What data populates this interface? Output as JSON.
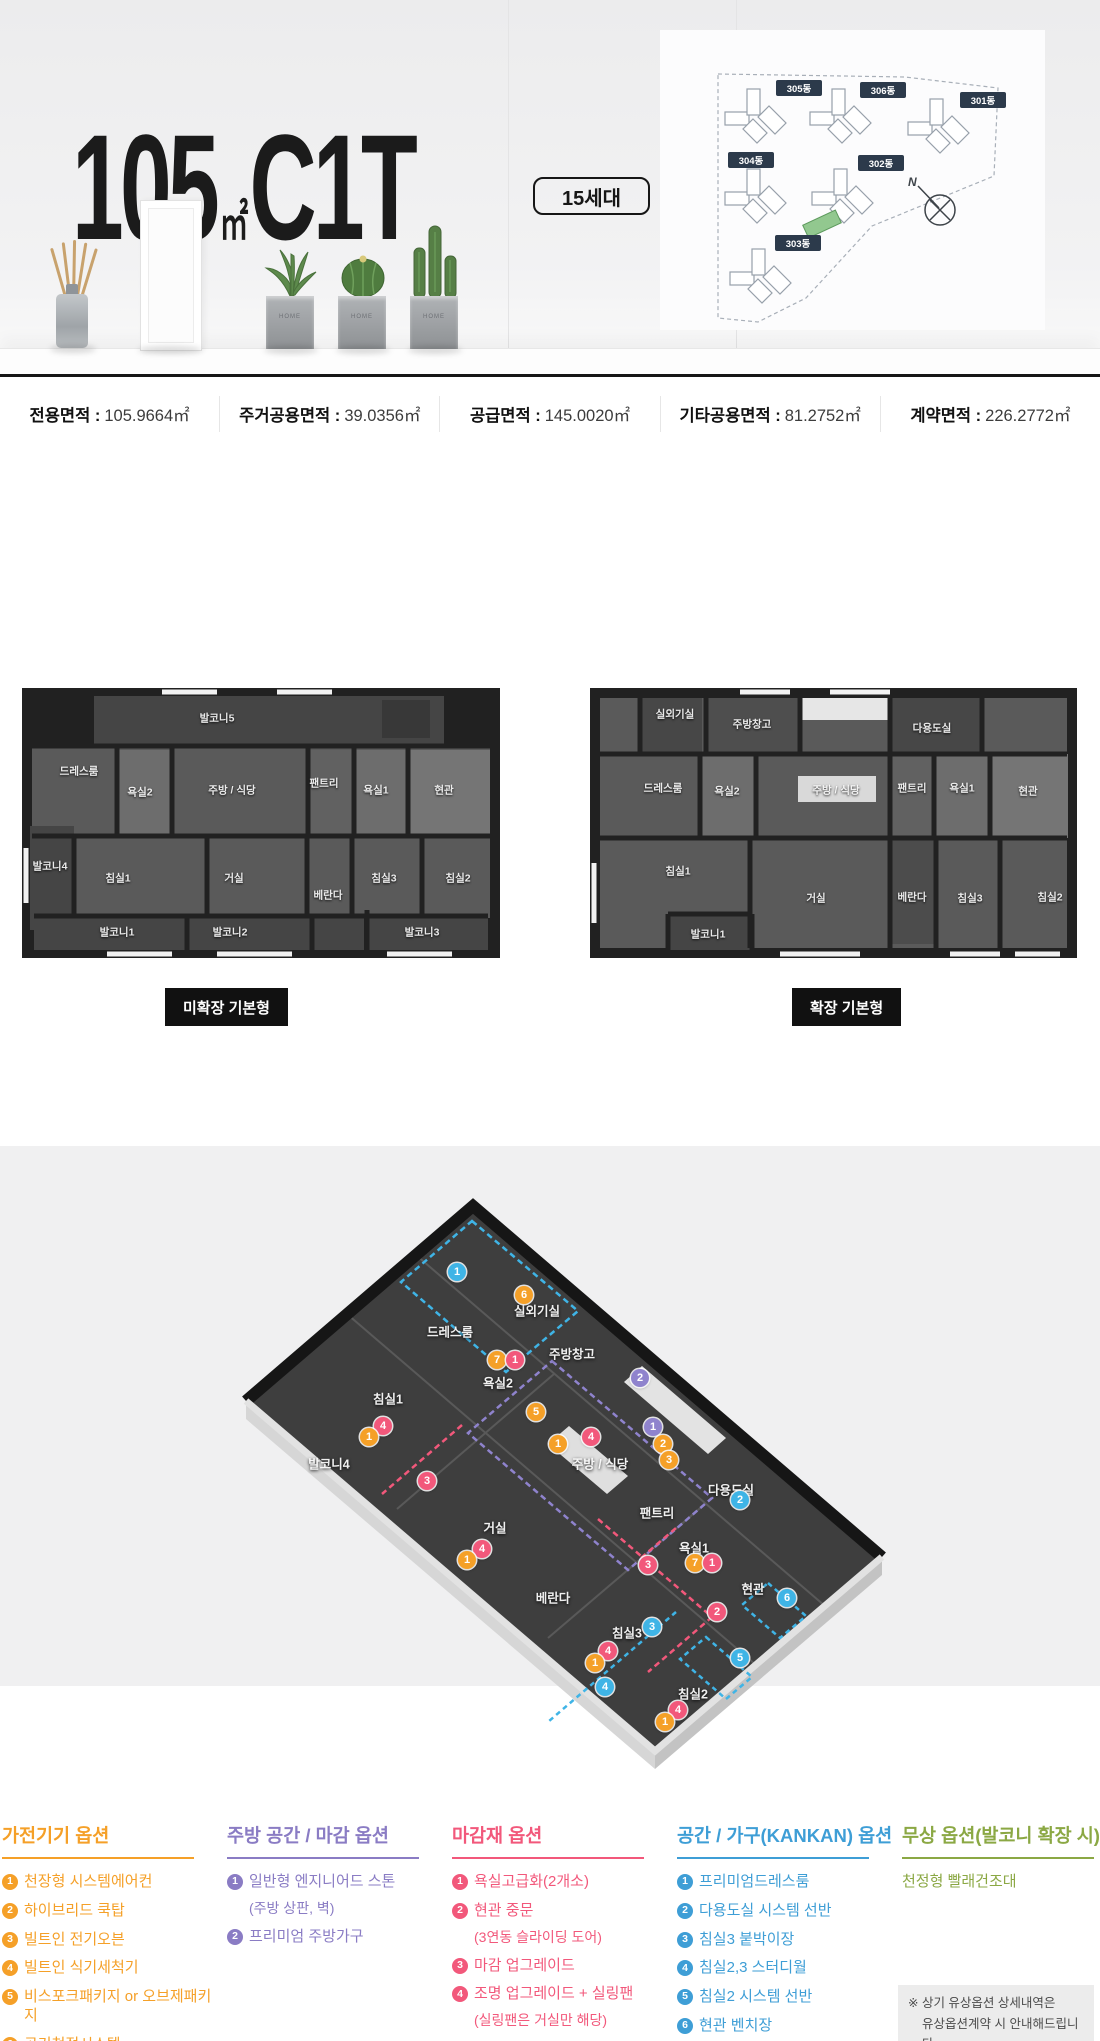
{
  "header": {
    "title": {
      "num": "105",
      "unit": "㎡",
      "type": "C1T"
    },
    "badge": "15세대",
    "site_plan": {
      "buildings": [
        {
          "name": "305동"
        },
        {
          "name": "306동"
        },
        {
          "name": "301동"
        },
        {
          "name": "304동"
        },
        {
          "name": "302동"
        },
        {
          "name": "303동"
        }
      ],
      "compass": "N",
      "highlight_color": "#92C88F",
      "chip_color": "#2C3A4B"
    }
  },
  "area_info": {
    "items": [
      {
        "label": "전용면적",
        "value": "105.9664㎡"
      },
      {
        "label": "주거공용면적",
        "value": "39.0356㎡"
      },
      {
        "label": "공급면적",
        "value": "145.0020㎡"
      },
      {
        "label": "기타공용면적",
        "value": "81.2752㎡"
      },
      {
        "label": "계약면적",
        "value": "226.2772㎡"
      }
    ]
  },
  "floor_plans": {
    "left": {
      "button_label": "미확장 기본형",
      "rooms": [
        {
          "name": "발코니5",
          "x": 195,
          "y": 30
        },
        {
          "name": "드레스룸",
          "x": 57,
          "y": 83
        },
        {
          "name": "욕실2",
          "x": 118,
          "y": 104
        },
        {
          "name": "주방 / 식당",
          "x": 210,
          "y": 102
        },
        {
          "name": "팬트리",
          "x": 302,
          "y": 95
        },
        {
          "name": "욕실1",
          "x": 354,
          "y": 102
        },
        {
          "name": "현관",
          "x": 422,
          "y": 102
        },
        {
          "name": "발코니4",
          "x": 28,
          "y": 178
        },
        {
          "name": "침실1",
          "x": 96,
          "y": 190
        },
        {
          "name": "거실",
          "x": 212,
          "y": 190
        },
        {
          "name": "베란다",
          "x": 306,
          "y": 207
        },
        {
          "name": "침실3",
          "x": 362,
          "y": 190
        },
        {
          "name": "침실2",
          "x": 436,
          "y": 190
        },
        {
          "name": "발코니1",
          "x": 95,
          "y": 244
        },
        {
          "name": "발코니2",
          "x": 208,
          "y": 244
        },
        {
          "name": "발코니3",
          "x": 400,
          "y": 244
        }
      ]
    },
    "right": {
      "button_label": "확장 기본형",
      "rooms": [
        {
          "name": "실외기실",
          "x": 85,
          "y": 26
        },
        {
          "name": "주방창고",
          "x": 162,
          "y": 36
        },
        {
          "name": "다용도실",
          "x": 342,
          "y": 40
        },
        {
          "name": "드레스룸",
          "x": 73,
          "y": 100
        },
        {
          "name": "욕실2",
          "x": 137,
          "y": 103
        },
        {
          "name": "주방 / 식당",
          "x": 246,
          "y": 102
        },
        {
          "name": "팬트리",
          "x": 322,
          "y": 100
        },
        {
          "name": "욕실1",
          "x": 372,
          "y": 100
        },
        {
          "name": "현관",
          "x": 438,
          "y": 103
        },
        {
          "name": "침실1",
          "x": 88,
          "y": 183
        },
        {
          "name": "거실",
          "x": 226,
          "y": 210
        },
        {
          "name": "베란다",
          "x": 322,
          "y": 209
        },
        {
          "name": "침실3",
          "x": 380,
          "y": 210
        },
        {
          "name": "침실2",
          "x": 460,
          "y": 209
        },
        {
          "name": "발코니1",
          "x": 118,
          "y": 246
        }
      ]
    }
  },
  "iso_plan": {
    "badge_colors": {
      "orange": "#F5A028",
      "pink": "#F2587B",
      "cyan": "#3FB4E6",
      "purple": "#8F83CD"
    },
    "labels": [
      {
        "text": "드레스룸",
        "x": 450,
        "y": 185
      },
      {
        "text": "실외기실",
        "x": 537,
        "y": 164
      },
      {
        "text": "주방창고",
        "x": 572,
        "y": 207
      },
      {
        "text": "욕실2",
        "x": 498,
        "y": 236
      },
      {
        "text": "침실1",
        "x": 388,
        "y": 252
      },
      {
        "text": "발코니4",
        "x": 329,
        "y": 317
      },
      {
        "text": "주방 / 식당",
        "x": 600,
        "y": 317
      },
      {
        "text": "다용도실",
        "x": 731,
        "y": 343
      },
      {
        "text": "팬트리",
        "x": 657,
        "y": 366
      },
      {
        "text": "거실",
        "x": 495,
        "y": 381
      },
      {
        "text": "욕실1",
        "x": 694,
        "y": 401
      },
      {
        "text": "베란다",
        "x": 553,
        "y": 451
      },
      {
        "text": "현관",
        "x": 753,
        "y": 442
      },
      {
        "text": "침실3",
        "x": 627,
        "y": 486
      },
      {
        "text": "침실2",
        "x": 693,
        "y": 547
      }
    ],
    "badges": [
      {
        "n": "1",
        "color": "cyan",
        "x": 457,
        "y": 126
      },
      {
        "n": "6",
        "color": "orange",
        "x": 524,
        "y": 149
      },
      {
        "n": "7",
        "color": "orange",
        "x": 497,
        "y": 214
      },
      {
        "n": "1",
        "color": "pink",
        "x": 515,
        "y": 214
      },
      {
        "n": "4",
        "color": "pink",
        "x": 383,
        "y": 280
      },
      {
        "n": "1",
        "color": "orange",
        "x": 369,
        "y": 291
      },
      {
        "n": "5",
        "color": "orange",
        "x": 536,
        "y": 266
      },
      {
        "n": "1",
        "color": "orange",
        "x": 558,
        "y": 298
      },
      {
        "n": "4",
        "color": "pink",
        "x": 591,
        "y": 291
      },
      {
        "n": "2",
        "color": "purple",
        "x": 640,
        "y": 232
      },
      {
        "n": "1",
        "color": "purple",
        "x": 653,
        "y": 281
      },
      {
        "n": "2",
        "color": "orange",
        "x": 663,
        "y": 298
      },
      {
        "n": "3",
        "color": "orange",
        "x": 669,
        "y": 314
      },
      {
        "n": "3",
        "color": "pink",
        "x": 427,
        "y": 335
      },
      {
        "n": "4",
        "color": "pink",
        "x": 482,
        "y": 403
      },
      {
        "n": "1",
        "color": "orange",
        "x": 467,
        "y": 414
      },
      {
        "n": "2",
        "color": "cyan",
        "x": 740,
        "y": 354
      },
      {
        "n": "7",
        "color": "orange",
        "x": 695,
        "y": 417
      },
      {
        "n": "1",
        "color": "pink",
        "x": 712,
        "y": 417
      },
      {
        "n": "3",
        "color": "pink",
        "x": 648,
        "y": 419
      },
      {
        "n": "2",
        "color": "pink",
        "x": 717,
        "y": 466
      },
      {
        "n": "6",
        "color": "cyan",
        "x": 787,
        "y": 452
      },
      {
        "n": "5",
        "color": "cyan",
        "x": 740,
        "y": 512
      },
      {
        "n": "3",
        "color": "cyan",
        "x": 652,
        "y": 481
      },
      {
        "n": "4",
        "color": "pink",
        "x": 608,
        "y": 505
      },
      {
        "n": "1",
        "color": "orange",
        "x": 595,
        "y": 517
      },
      {
        "n": "4",
        "color": "cyan",
        "x": 605,
        "y": 541
      },
      {
        "n": "4",
        "color": "pink",
        "x": 678,
        "y": 564
      },
      {
        "n": "1",
        "color": "orange",
        "x": 665,
        "y": 576
      }
    ]
  },
  "options": {
    "columns": [
      {
        "title": "가전기기 옵션",
        "color": "#F5A028",
        "items": [
          {
            "n": "1",
            "text": "천장형 시스템에어컨"
          },
          {
            "n": "2",
            "text": "하이브리드 쿡탑"
          },
          {
            "n": "3",
            "text": "빌트인 전기오븐"
          },
          {
            "n": "4",
            "text": "빌트인 식기세척기"
          },
          {
            "n": "5",
            "text": "비스포크패키지 or 오브제패키지"
          },
          {
            "n": "6",
            "text": "공기청정시스템"
          },
          {
            "n": "7",
            "text": "욕실 스마트 환기팬(2개소)"
          }
        ]
      },
      {
        "title": "주방 공간 / 마감 옵션",
        "color": "#8A7CC4",
        "items": [
          {
            "n": "1",
            "text": "일반형 엔지니어드 스톤",
            "sub": "(주방 상판, 벽)"
          },
          {
            "n": "2",
            "text": "프리미엄 주방가구"
          }
        ]
      },
      {
        "title": "마감재 옵션",
        "color": "#F2587B",
        "items": [
          {
            "n": "1",
            "text": "욕실고급화(2개소)"
          },
          {
            "n": "2",
            "text": "현관 중문",
            "sub": "(3연동 슬라이딩 도어)"
          },
          {
            "n": "3",
            "text": "마감 업그레이드"
          },
          {
            "n": "4",
            "text": "조명 업그레이드 + 실링팬",
            "sub": "(실링팬은 거실만 해당)"
          }
        ]
      },
      {
        "title": "공간 / 가구(KANKAN) 옵션",
        "color": "#3E9ED6",
        "items": [
          {
            "n": "1",
            "text": "프리미엄드레스룸"
          },
          {
            "n": "2",
            "text": "다용도실 시스템 선반"
          },
          {
            "n": "3",
            "text": "침실3 붙박이장"
          },
          {
            "n": "4",
            "text": "침실2,3 스터디월"
          },
          {
            "n": "5",
            "text": "침실2 시스템 선반"
          },
          {
            "n": "6",
            "text": "현관 벤치장"
          }
        ]
      },
      {
        "title": "무상 옵션(발코니 확장 시)",
        "color": "#8BA844",
        "items": [
          {
            "text": "천정형 빨래건조대"
          }
        ]
      }
    ],
    "notice": [
      "※ 상기 유상옵션 상세내역은",
      "유상옵션계약 시 안내해드립니다."
    ]
  }
}
